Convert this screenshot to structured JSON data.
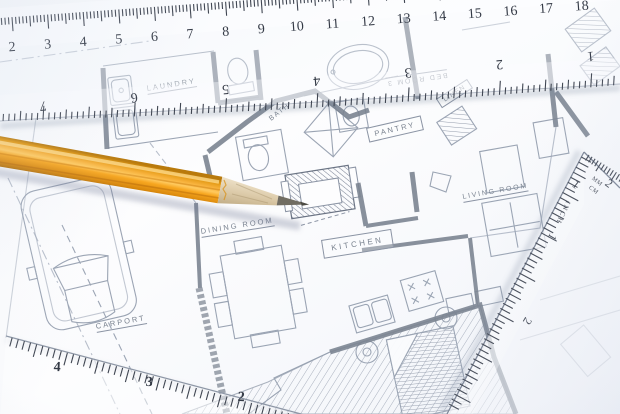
{
  "plan_labels": {
    "laundry": "LAUNDRY",
    "bath": "BATH",
    "pantry": "PANTRY",
    "linen": "LINEN",
    "living_room": "LIVING ROOM",
    "bed_room": "BED ROOM 3",
    "dining_room": "DINING ROOM",
    "kitchen": "KITCHEN",
    "carport": "CARPORT"
  },
  "top_ruler": {
    "cm_numbers": [
      2,
      3,
      4,
      5,
      6,
      7,
      8,
      9,
      10,
      11,
      12,
      13,
      14,
      15,
      16,
      17,
      18
    ],
    "inch_numbers": [
      7,
      6,
      5,
      4,
      3,
      2,
      1
    ]
  },
  "triangle_ruler": {
    "top_numbers": [
      1,
      2
    ],
    "mm_label": "MM",
    "cm_label": "CM",
    "inch_label": "INCH",
    "side_numbers": [
      1,
      2
    ]
  },
  "corner_ruler": {
    "numbers": [
      4,
      3,
      2
    ]
  },
  "colors": {
    "pencil_orange": "#f2a31c",
    "plan_line": "#96a0b0",
    "wall": "#79828f",
    "paper": "#f7f9fc"
  }
}
